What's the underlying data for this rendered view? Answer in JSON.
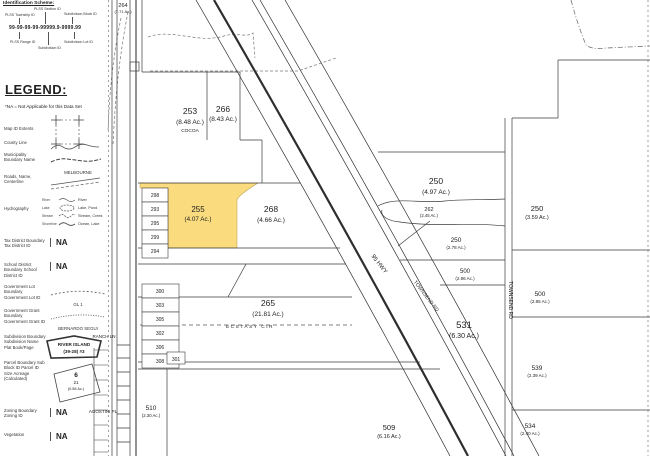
{
  "idScheme": {
    "title": "Identification Scheme:",
    "format": "99-99-99-99-99999.9-9999.99",
    "labels": [
      "PLSS Township ID",
      "PLSS Section ID",
      "Subdivision Block ID",
      "PLSS Range ID",
      "Subdivision ID",
      "Subdivision Lot ID"
    ]
  },
  "legend": {
    "title": "LEGEND:",
    "note": "*NA = Not Applicable for this Data Set",
    "items": [
      {
        "label": "Map ID Extents"
      },
      {
        "label": "County Line"
      },
      {
        "label": "Municipality Boundary Name",
        "sample": "MELBOURNE"
      },
      {
        "label": "Roads, Name, Centerline"
      },
      {
        "label": "Hydrography",
        "left": [
          "River",
          "Lake",
          "Stream",
          "Shoreline"
        ],
        "right": [
          "River",
          "Lake, Pond",
          "Stream, Creek",
          "Ocean, Lake"
        ]
      },
      {
        "label": "Tax District Boundary Tax District ID",
        "value": "NA"
      },
      {
        "label": "School District Boundary School District ID",
        "value": "NA"
      },
      {
        "label": "Government Lot Boundary Government Lot ID",
        "sample": "GL 1"
      },
      {
        "label": "Government Grant Boundary Government Grant ID",
        "sample": "BERNARDO SEGUI"
      },
      {
        "label": "Subdivision Boundary Subdivision Name Plat Book/Page",
        "sample_line1": "RIVER ISLAND",
        "sample_line2": "(39-28) #3"
      },
      {
        "label": "Parcel Boundary Sub Block ID Parcel ID Size Acreage (Calculated)",
        "sample_block": "6",
        "sample_parcel": "21",
        "sample_acreage": "(0.58 Ac.)"
      },
      {
        "label": "Zoning Boundary Zoning ID",
        "value": "NA"
      },
      {
        "label": "Vegetation",
        "value": "NA"
      }
    ]
  },
  "map": {
    "highlight_color": "#FADC7F",
    "parcels": [
      {
        "id": "264",
        "acreage": "(7.71 Ac.)"
      },
      {
        "id": "253",
        "acreage": "(8.48 Ac.)",
        "municipality": "COCOA"
      },
      {
        "id": "266",
        "acreage": "(8.43 Ac.)"
      },
      {
        "id": "255",
        "acreage": "(4.07 Ac.)"
      },
      {
        "id": "268",
        "acreage": "(4.66 Ac.)"
      },
      {
        "id": "265",
        "acreage": "(21.81 Ac.)"
      },
      {
        "id": "250",
        "acreage": "(4.97 Ac.)"
      },
      {
        "id": "262",
        "acreage": "(2.45 Ac.)"
      },
      {
        "id": "250",
        "acreage": "(2.78 Ac.)"
      },
      {
        "id": "250",
        "acreage": "(3.59 Ac.)"
      },
      {
        "id": "500",
        "acreage": "(2.96 Ac.)"
      },
      {
        "id": "500",
        "acreage": "(2.85 Ac.)"
      },
      {
        "id": "531",
        "acreage": "(6.30 Ac.)"
      },
      {
        "id": "539",
        "acreage": "(2.39 Ac.)"
      },
      {
        "id": "509",
        "acreage": "(6.16 Ac.)"
      },
      {
        "id": "510",
        "acreage": "(2.30 Ac.)"
      },
      {
        "id": "534",
        "acreage": "(2.40 Ac.)"
      }
    ],
    "small_parcels": [
      "298",
      "293",
      "295",
      "299",
      "294",
      "300",
      "303",
      "305",
      "302",
      "306",
      "308",
      "301"
    ],
    "roads": {
      "highway": "95 HWY",
      "townsend_diag": "TOWNSEND RD",
      "townsend_vert": "TOWNSEND RD",
      "ecstasy": "ECSTASY CIR",
      "ranch": "RANCH LN",
      "agostini": "AGOSTINI PL"
    }
  }
}
